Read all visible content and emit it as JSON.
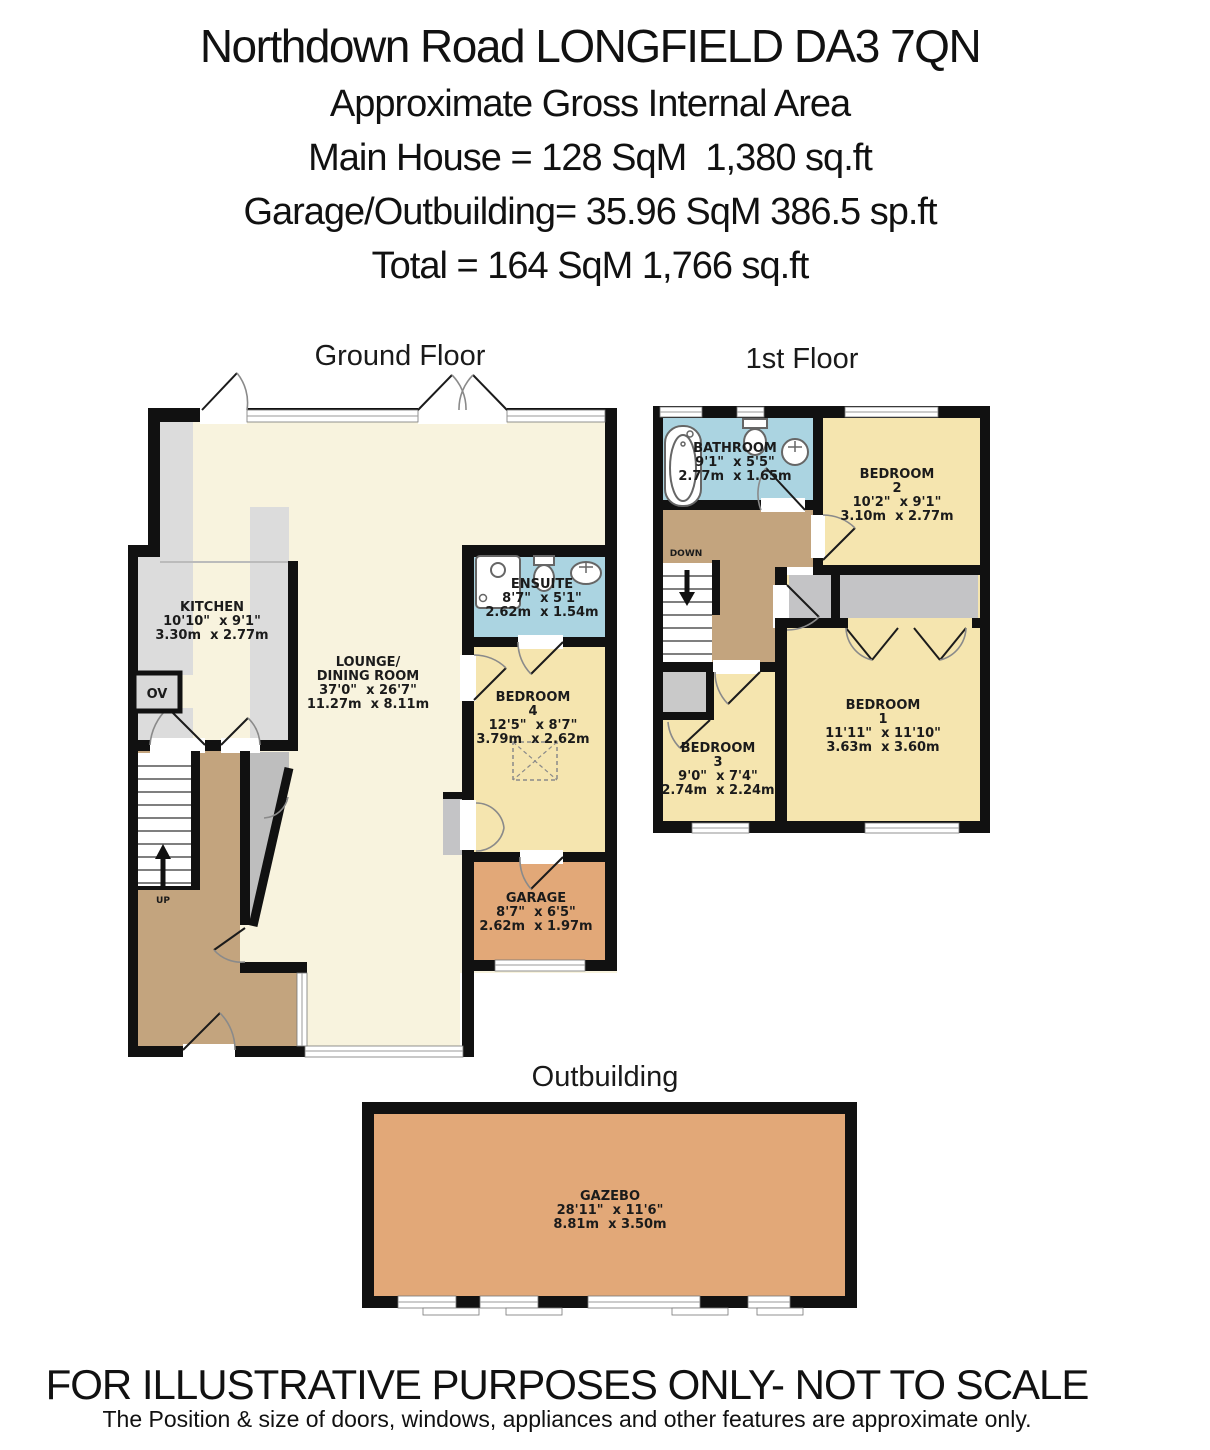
{
  "header": {
    "title": "Northdown Road LONGFIELD DA3 7QN",
    "subtitle": "Approximate Gross Internal Area",
    "main_house": "Main House = 128 SqM  1,380 sq.ft",
    "garage_outbuilding": "Garage/Outbuilding= 35.96 SqM 386.5 sp.ft",
    "total": "Total = 164 SqM 1,766 sq.ft"
  },
  "plan": {
    "ground": {
      "title": "Ground Floor",
      "kitchen": {
        "name": "KITCHEN",
        "imperial": "10'10\"  x 9'1\"",
        "metric": "3.30m  x 2.77m"
      },
      "lounge": {
        "name1": "LOUNGE/",
        "name2": "DINING ROOM",
        "imperial": "37'0\"  x 26'7\"",
        "metric": "11.27m  x 8.11m"
      },
      "ensuite": {
        "name": "ENSUITE",
        "imperial": "8'7\"  x 5'1\"",
        "metric": "2.62m  x 1.54m"
      },
      "bedroom4": {
        "name": "BEDROOM",
        "number": "4",
        "imperial": "12'5\"  x 8'7\"",
        "metric": "3.79m  x 2.62m"
      },
      "garage": {
        "name": "GARAGE",
        "imperial": "8'7\"  x 6'5\"",
        "metric": "2.62m  x 1.97m"
      },
      "oven": "OV",
      "stairs": "UP"
    },
    "first": {
      "title": "1st Floor",
      "bathroom": {
        "name": "BATHROOM",
        "imperial": "9'1\"  x 5'5\"",
        "metric": "2.77m  x 1.65m"
      },
      "bedroom2": {
        "name": "BEDROOM",
        "number": "2",
        "imperial": "10'2\"  x 9'1\"",
        "metric": "3.10m  x 2.77m"
      },
      "bedroom1": {
        "name": "BEDROOM",
        "number": "1",
        "imperial": "11'11\"  x 11'10\"",
        "metric": "3.63m  x 3.60m"
      },
      "bedroom3": {
        "name": "BEDROOM",
        "number": "3",
        "imperial": "9'0\"  x 7'4\"",
        "metric": "2.74m  x 2.24m"
      },
      "stairs": "DOWN"
    },
    "outbuilding": {
      "title": "Outbuilding",
      "gazebo": {
        "name": "GAZEBO",
        "imperial": "28'11\"  x 11'6\"",
        "metric": "8.81m  x 3.50m"
      }
    }
  },
  "footer": {
    "line1": "FOR ILLUSTRATIVE PURPOSES ONLY- NOT TO SCALE",
    "line2": "The Position & size of doors, windows, appliances and other features are approximate only."
  },
  "colors": {
    "wall": "#111111",
    "lounge_cream": "#F8F3DE",
    "bedroom_yellow": "#F5E5AF",
    "bath_blue": "#ABD4E1",
    "hall_brown": "#C3A47E",
    "garage_orange": "#E2A878",
    "counter_gray": "#DCDCDC",
    "storage_gray": "#C4C4C6"
  }
}
